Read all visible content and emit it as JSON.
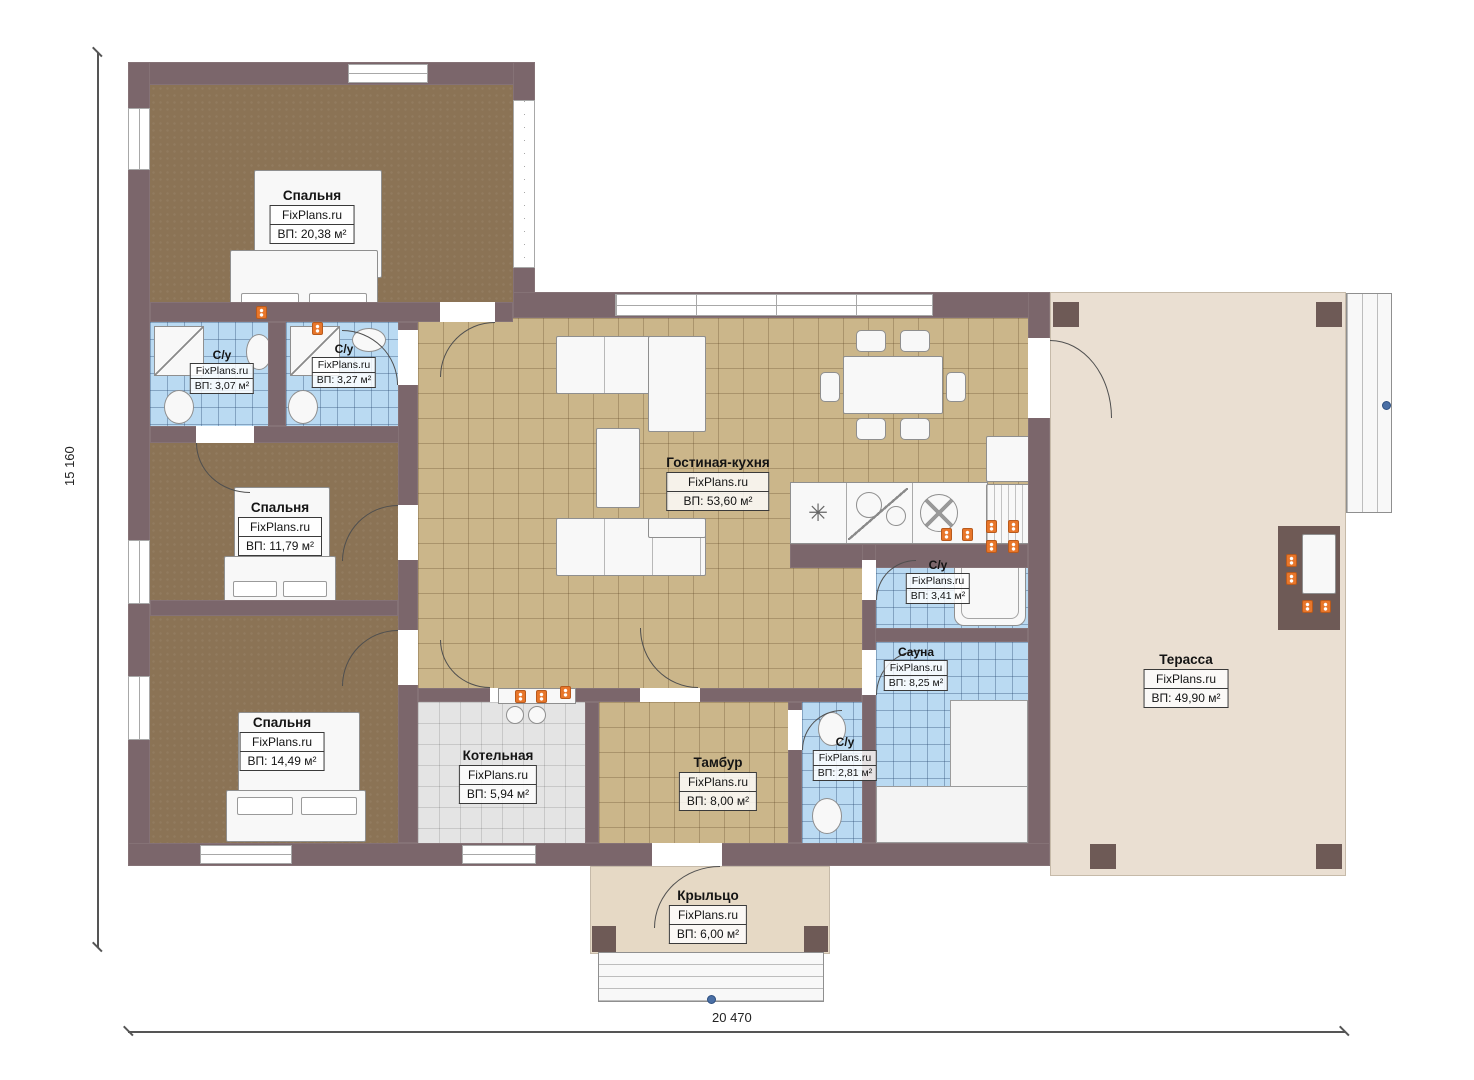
{
  "brand": "FixPlans.ru",
  "dimensions": {
    "height_label": "15 160",
    "width_label": "20 470"
  },
  "icons": {
    "vent_symbol": "✳"
  },
  "colors": {
    "wall": "#7b666b",
    "bedroom_floor": "#8b7355",
    "living_floor": "#cbb68a",
    "wet_room_floor": "#badaf2",
    "boiler_floor": "#e4e4e4",
    "terrace_floor": "#eadfd2",
    "porch_floor": "#e6d9c5",
    "outlet": "#e8762a",
    "direction_marker": "#4a6fa5"
  },
  "rooms": [
    {
      "id": "bedroom-1",
      "name": "Спальня",
      "area": "ВП: 20,38 м²"
    },
    {
      "id": "bathroom-1",
      "name": "С/у",
      "area": "ВП: 3,07 м²"
    },
    {
      "id": "bathroom-2",
      "name": "С/у",
      "area": "ВП: 3,27 м²"
    },
    {
      "id": "bedroom-2",
      "name": "Спальня",
      "area": "ВП: 11,79 м²"
    },
    {
      "id": "bedroom-3",
      "name": "Спальня",
      "area": "ВП: 14,49 м²"
    },
    {
      "id": "living-kitchen",
      "name": "Гостиная-кухня",
      "area": "ВП: 53,60 м²"
    },
    {
      "id": "bathroom-3",
      "name": "С/у",
      "area": "ВП: 3,41 м²"
    },
    {
      "id": "sauna",
      "name": "Сауна",
      "area": "ВП: 8,25 м²"
    },
    {
      "id": "bathroom-4",
      "name": "С/у",
      "area": "ВП: 2,81 м²"
    },
    {
      "id": "boiler-room",
      "name": "Котельная",
      "area": "ВП: 5,94 м²"
    },
    {
      "id": "tambour",
      "name": "Тамбур",
      "area": "ВП: 8,00 м²"
    },
    {
      "id": "terrace",
      "name": "Терасса",
      "area": "ВП: 49,90 м²"
    },
    {
      "id": "porch",
      "name": "Крыльцо",
      "area": "ВП: 6,00 м²"
    }
  ]
}
